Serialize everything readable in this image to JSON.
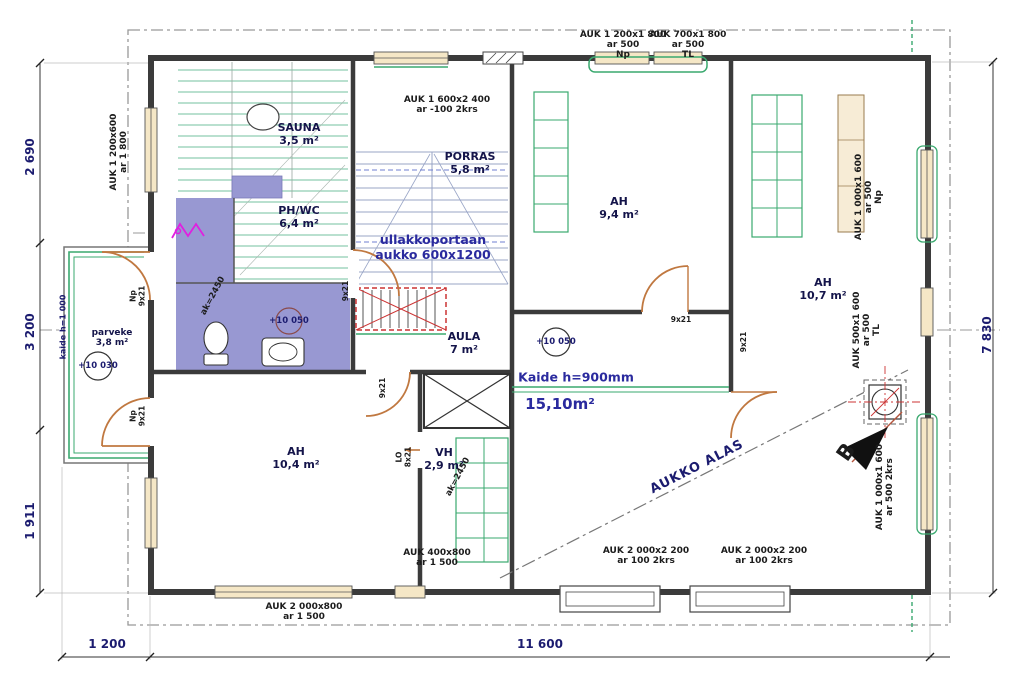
{
  "drawing": {
    "dims": {
      "left_top": "2 690",
      "left_mid": "3 200",
      "left_bottom": "1 911",
      "right": "7 830",
      "bottom_small": "1 200",
      "bottom_main": "11 600"
    },
    "rooms": {
      "sauna": {
        "name": "SAUNA",
        "area": "3,5 m²"
      },
      "phwc": {
        "name": "PH/WC",
        "area": "6,4 m²"
      },
      "porras": {
        "name": "PORRAS",
        "area": "5,8 m²"
      },
      "ah_top": {
        "name": "AH",
        "area": "9,4 m²"
      },
      "ah_right": {
        "name": "AH",
        "area": "10,7 m²"
      },
      "ah_left": {
        "name": "AH",
        "area": "10,4 m²"
      },
      "aula": {
        "name": "AULA",
        "area": "7 m²"
      },
      "vh": {
        "name": "VH",
        "area": "2,9 m²"
      },
      "parveke": {
        "name": "parveke",
        "area": "3,8 m²"
      }
    },
    "openings": {
      "left": {
        "l1": "AUK 1 200x600",
        "l2": "ar 1 800"
      },
      "top_np": {
        "l1": "AUK 1 200x1 800",
        "l2": "ar 500",
        "l3": "Np"
      },
      "top_tl": {
        "l1": "AUK 700x1 800",
        "l2": "ar 500",
        "l3": "TL"
      },
      "porras": {
        "l1": "AUK 1 600x2 400",
        "l2": "ar -100 2krs"
      },
      "right_np": {
        "l1": "AUK 1 000x1 600",
        "l2": "ar 500",
        "l3": "Np"
      },
      "right_tl": {
        "l1": "AUK 500x1 600",
        "l2": "ar 500",
        "l3": "TL"
      },
      "right_2krs": {
        "l1": "AUK 1 000x1 600",
        "l2": "ar 500 2krs"
      },
      "bottom_small": {
        "l1": "AUK 400x800",
        "l2": "ar 1 500"
      },
      "bottom_2krs_a": {
        "l1": "AUK 2 000x2 200",
        "l2": "ar 100 2krs"
      },
      "bottom_2krs_b": {
        "l1": "AUK 2 000x2 200",
        "l2": "ar 100 2krs"
      },
      "bottom_left": {
        "l1": "AUK 2 000x800",
        "l2": "ar 1 500"
      }
    },
    "annotations": {
      "attic_1": "ullakkoportaan",
      "attic_2": "aukko 600x1200",
      "railing": "Kaide h=900mm",
      "landing_area": "15,10m²",
      "opening_down": "AUKKO ALAS",
      "level_phwc": "+10 050",
      "level_aula": "+10 050",
      "level_balcony": "+10 030",
      "balcony_railing": "kaide h=1 000",
      "height_1": "ak=2450",
      "height_2": "ak=2450",
      "section_mark": "B"
    },
    "door_tags": {
      "d_np_top": {
        "l1": "Np",
        "l2": "9x21"
      },
      "d_np_bottom": {
        "l1": "Np",
        "l2": "9x21"
      },
      "d_phwc": "9x21",
      "d_aula": "9x21",
      "d_ah_top": "9x21",
      "d_ah_right": "9x21",
      "d_vh": {
        "l1": "LO",
        "l2": "8x21"
      }
    },
    "colors": {
      "wall": "#3b3b3b",
      "annotation_blue": "#2a2a9e",
      "dimension_navy": "#1b1b6f",
      "room_fill_purple": "#9898d2",
      "fixture_green": "#3aa96f",
      "door_tan": "#c07840",
      "window_beige": "#f5e7c6",
      "accent_red": "#cc3333",
      "accent_magenta": "#e020e0",
      "boundary_grey": "#999999"
    }
  }
}
